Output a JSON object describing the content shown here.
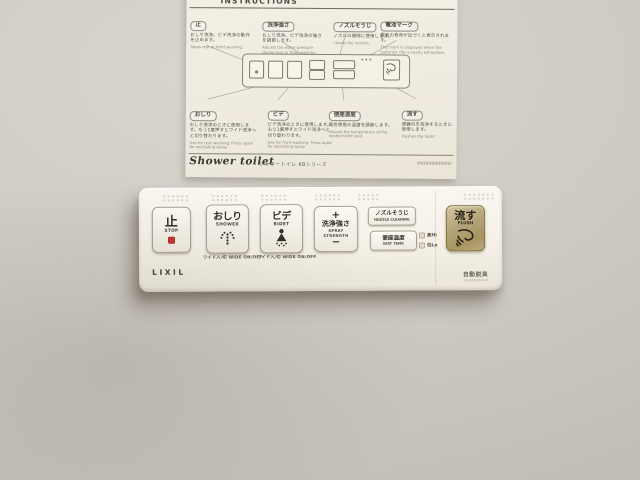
{
  "colors": {
    "wall": "#cfcbc4",
    "paper": "#f0ece1",
    "panel": "#f6f2e9",
    "accent_red": "#c5302c",
    "flush_gold": "#b4a377"
  },
  "sheet": {
    "title": "INSTRUCTIONS",
    "top_boxes": [
      {
        "label": "止",
        "jp": "おしり洗浄、ビデ洗浄の動作を止めます。",
        "en": "Stops rear or front washing."
      },
      {
        "label": "洗浄強さ",
        "jp": "おしり洗浄、ビデ洗浄の強さを調節します。",
        "en": "Adjusts the water pressure during rear or front washing."
      },
      {
        "label": "ノズルそうじ",
        "jp": "ノズルの掃除に使用します。",
        "en": "Cleans the nozzles."
      },
      {
        "label": "電池マーク",
        "jp": "電池の寿命が近づくと表示されます。",
        "en": "This mark is displayed when the batteries' life is nearly exhausted."
      }
    ],
    "bottom_boxes": [
      {
        "label": "おしり",
        "jp": "おしり洗浄のときに使用します。もう1度押すとワイド洗浄へと切り替わります。",
        "en": "Use for rear washing. Press again for oscillating spray."
      },
      {
        "label": "ビデ",
        "jp": "ビデ洗浄のときに使用します。もう1度押すとワイド洗浄へと切り替わります。",
        "en": "Use for front washing. Press again for oscillating spray."
      },
      {
        "label": "便座温度",
        "jp": "暖房便座の温度を調節します。",
        "en": "Adjusts the temperature of the heated toilet seat."
      },
      {
        "label": "流す",
        "jp": "便器内を洗浄するときに使用します。",
        "en": "Flushes the toilet."
      }
    ],
    "footer": {
      "script_logo": "Shower toilet",
      "series": "シャワートイレ KBシリーズ"
    }
  },
  "panel": {
    "buttons": {
      "stop": {
        "jp": "止",
        "en": "STOP"
      },
      "shower": {
        "jp": "おしり",
        "en": "SHOWER",
        "sub_jp": "ワイド入/切",
        "sub_en": "WIDE ON/OFF"
      },
      "bidet": {
        "jp": "ビデ",
        "en": "BIDET",
        "sub_jp": "ワイド入/切",
        "sub_en": "WIDE ON/OFF"
      },
      "spray": {
        "plus": "+",
        "jp": "洗浄強さ",
        "en": "SPRAY STRENGTH",
        "minus": "−"
      },
      "nozzle": {
        "jp": "ノズルそうじ",
        "en": "NOZZLE CLEANING"
      },
      "seat_temp": {
        "jp": "便座温度",
        "en": "SEAT TEMP."
      },
      "flush": {
        "jp": "流す",
        "en": "FLUSH"
      }
    },
    "indicators": {
      "hi": "高Hi",
      "lo": "低Lo"
    },
    "brand": "LIXIL",
    "deodorizer": "自動脱臭"
  }
}
